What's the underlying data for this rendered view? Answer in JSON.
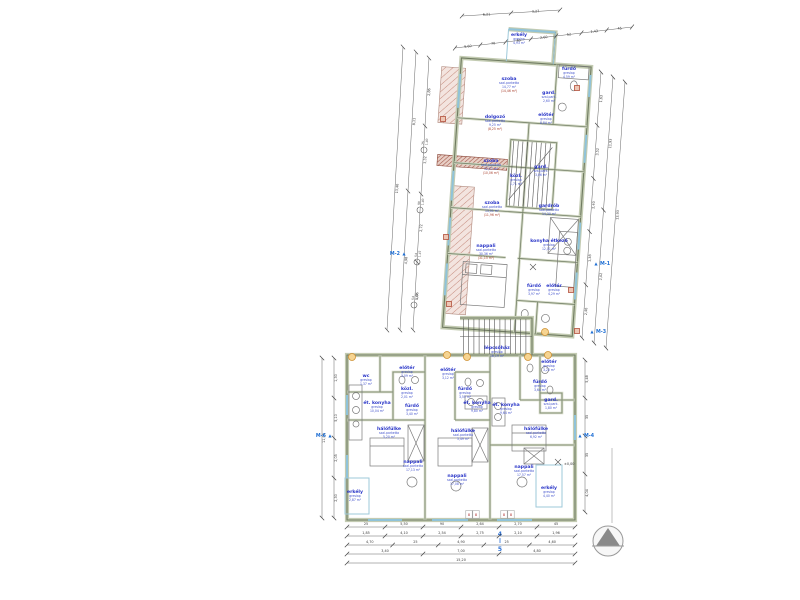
{
  "document": {
    "type": "architectural floor plan",
    "language": "Hungarian"
  },
  "colors": {
    "label_blue": "#2a36c8",
    "secondary_blue": "#4353cc",
    "paren_red": "#a8402e",
    "wall_olive": "#6f7b60",
    "hatch_pink": "#c4897b",
    "hatch_dark": "#a3584a",
    "marker_blue": "#1f6fd4",
    "bubble_orange": "#cf9030",
    "window_blue": "#8fc3d9",
    "dim_gray": "#3a3a3a"
  },
  "rooms": [
    {
      "name": "erkély",
      "floor": "greslap",
      "area": "4,93 m²"
    },
    {
      "name": "szoba",
      "floor": "szal.parketta",
      "area": "14,77 m²",
      "area2": "(14,46 m²)"
    },
    {
      "name": "fürdő",
      "floor": "greslap",
      "area": "4,59 m²"
    },
    {
      "name": "gard.",
      "floor": "szal.park.",
      "area": "2,60 m²"
    },
    {
      "name": "dolgozó",
      "floor": "szal.parketta",
      "area": "9,25 m²",
      "area2": "(8,25 m²)"
    },
    {
      "name": "előtér",
      "floor": "greslap",
      "area": "8,84 m²"
    },
    {
      "name": "szoba",
      "floor": "szal.parketta",
      "area": "12,17 m²",
      "area2": "(10,06 m²)"
    },
    {
      "name": "közl.",
      "floor": "greslap",
      "area": "1,71 m²"
    },
    {
      "name": "gard.",
      "floor": "szal.park.",
      "area": "3,06 m²"
    },
    {
      "name": "szoba",
      "floor": "szal.parketta",
      "area": "13,01 m²",
      "area2": "(11,96 m²)"
    },
    {
      "name": "gardrób",
      "floor": "szal.parketta",
      "area": "14,30 m²"
    },
    {
      "name": "nappali",
      "floor": "szal.parketta",
      "area": "30,36 m²",
      "area2": "(31,15 m²)"
    },
    {
      "name": "konyha étkező",
      "floor": "greslap",
      "area": "12,01 m²"
    },
    {
      "name": "fürdő",
      "floor": "greslap",
      "area": "3,97 m²"
    },
    {
      "name": "előtér",
      "floor": "greslap",
      "area": "4,29 m²"
    },
    {
      "name": "lépcsőház",
      "floor": "greslap",
      "area": "16,19 m²"
    },
    {
      "name": "wc",
      "floor": "greslap",
      "area": "1,37 m²"
    },
    {
      "name": "előtér",
      "floor": "greslap",
      "area": "3,09 m²"
    },
    {
      "name": "közl.",
      "floor": "greslap",
      "area": "2,01 m²"
    },
    {
      "name": "ét. konyha",
      "floor": "greslap",
      "area": "10,04 m²"
    },
    {
      "name": "fürdő",
      "floor": "greslap",
      "area": "3,40 m²"
    },
    {
      "name": "hálófülke",
      "floor": "szal.parketta",
      "area": "5,20 m²"
    },
    {
      "name": "nappali",
      "floor": "szal.parketta",
      "area": "17,13 m²"
    },
    {
      "name": "erkély",
      "floor": "greslap",
      "area": "2,87 m²"
    },
    {
      "name": "előtér",
      "floor": "greslap",
      "area": "3,12 m²"
    },
    {
      "name": "fürdő",
      "floor": "greslap",
      "area": "3,55 m²"
    },
    {
      "name": "ét. konyha",
      "floor": "greslap",
      "area": "9,80 m²"
    },
    {
      "name": "hálófülke",
      "floor": "szal.parketta",
      "area": "5,49 m²"
    },
    {
      "name": "nappali",
      "floor": "szal.parketta",
      "area": "17,08 m²"
    },
    {
      "name": "előtér",
      "floor": "greslap",
      "area": "3,20 m²"
    },
    {
      "name": "fürdő",
      "floor": "greslap",
      "area": "3,64 m²"
    },
    {
      "name": "gard.",
      "floor": "szal.park.",
      "area": "1,80 m²"
    },
    {
      "name": "ét. konyha",
      "floor": "greslap",
      "area": "9,64 m²"
    },
    {
      "name": "hálófülke",
      "floor": "szal.parketta",
      "area": "6,92 m²"
    },
    {
      "name": "nappali",
      "floor": "szal.parketta",
      "area": "17,57 m²"
    },
    {
      "name": "erkély",
      "floor": "greslap",
      "area": "4,40 m²"
    }
  ],
  "dimensions": {
    "top": [
      [
        "6,21",
        "3,27"
      ],
      [
        "9,60",
        "70",
        "30",
        "2,60",
        "52",
        "1,43",
        "45"
      ]
    ],
    "left_upper": [
      [
        "2,86",
        "3,32",
        "2,72",
        "4,06"
      ],
      [
        "8,11",
        "4,98"
      ],
      [
        "13,46"
      ]
    ],
    "right_upper": [
      [
        "1,63",
        "3,52",
        "2,40",
        "1,38",
        "2,46"
      ],
      [
        "11,93",
        "2,02"
      ],
      [
        "13,93"
      ]
    ],
    "bottom": [
      [
        "25",
        "5,50",
        "90",
        "2,64",
        "2,70",
        "45"
      ],
      [
        "1,85",
        "4,10",
        "2,54",
        "2,75",
        "2,10",
        "1,96"
      ],
      [
        "4,70",
        "25",
        "4,90",
        "25",
        "4,60"
      ],
      [
        "3,40",
        "7,00",
        "4,80"
      ],
      [
        "15,20"
      ]
    ],
    "left_lower": [
      [
        "1,30",
        "5,10",
        "2,05",
        "2,30"
      ],
      [
        "11,05"
      ]
    ],
    "right_lower": [
      [
        "5,48",
        "35",
        "35",
        "4,04"
      ]
    ]
  },
  "window_tags": [
    {
      "w": "75",
      "h": "1,40"
    },
    {
      "w": "90",
      "h": "1,40"
    },
    {
      "w": "54",
      "h": "1,47"
    },
    {
      "w": "54",
      "h": "1,40"
    }
  ],
  "door_tags": [
    "8",
    "8",
    "8",
    "8"
  ],
  "section_markers": [
    "M-1",
    "M-2",
    "M-3",
    "M-4",
    "M-6"
  ],
  "section_cut": {
    "top": "4",
    "bottom": "5"
  },
  "level_marks": [
    "±0,00"
  ],
  "north_arrow": {
    "icon": "north-arrow"
  }
}
